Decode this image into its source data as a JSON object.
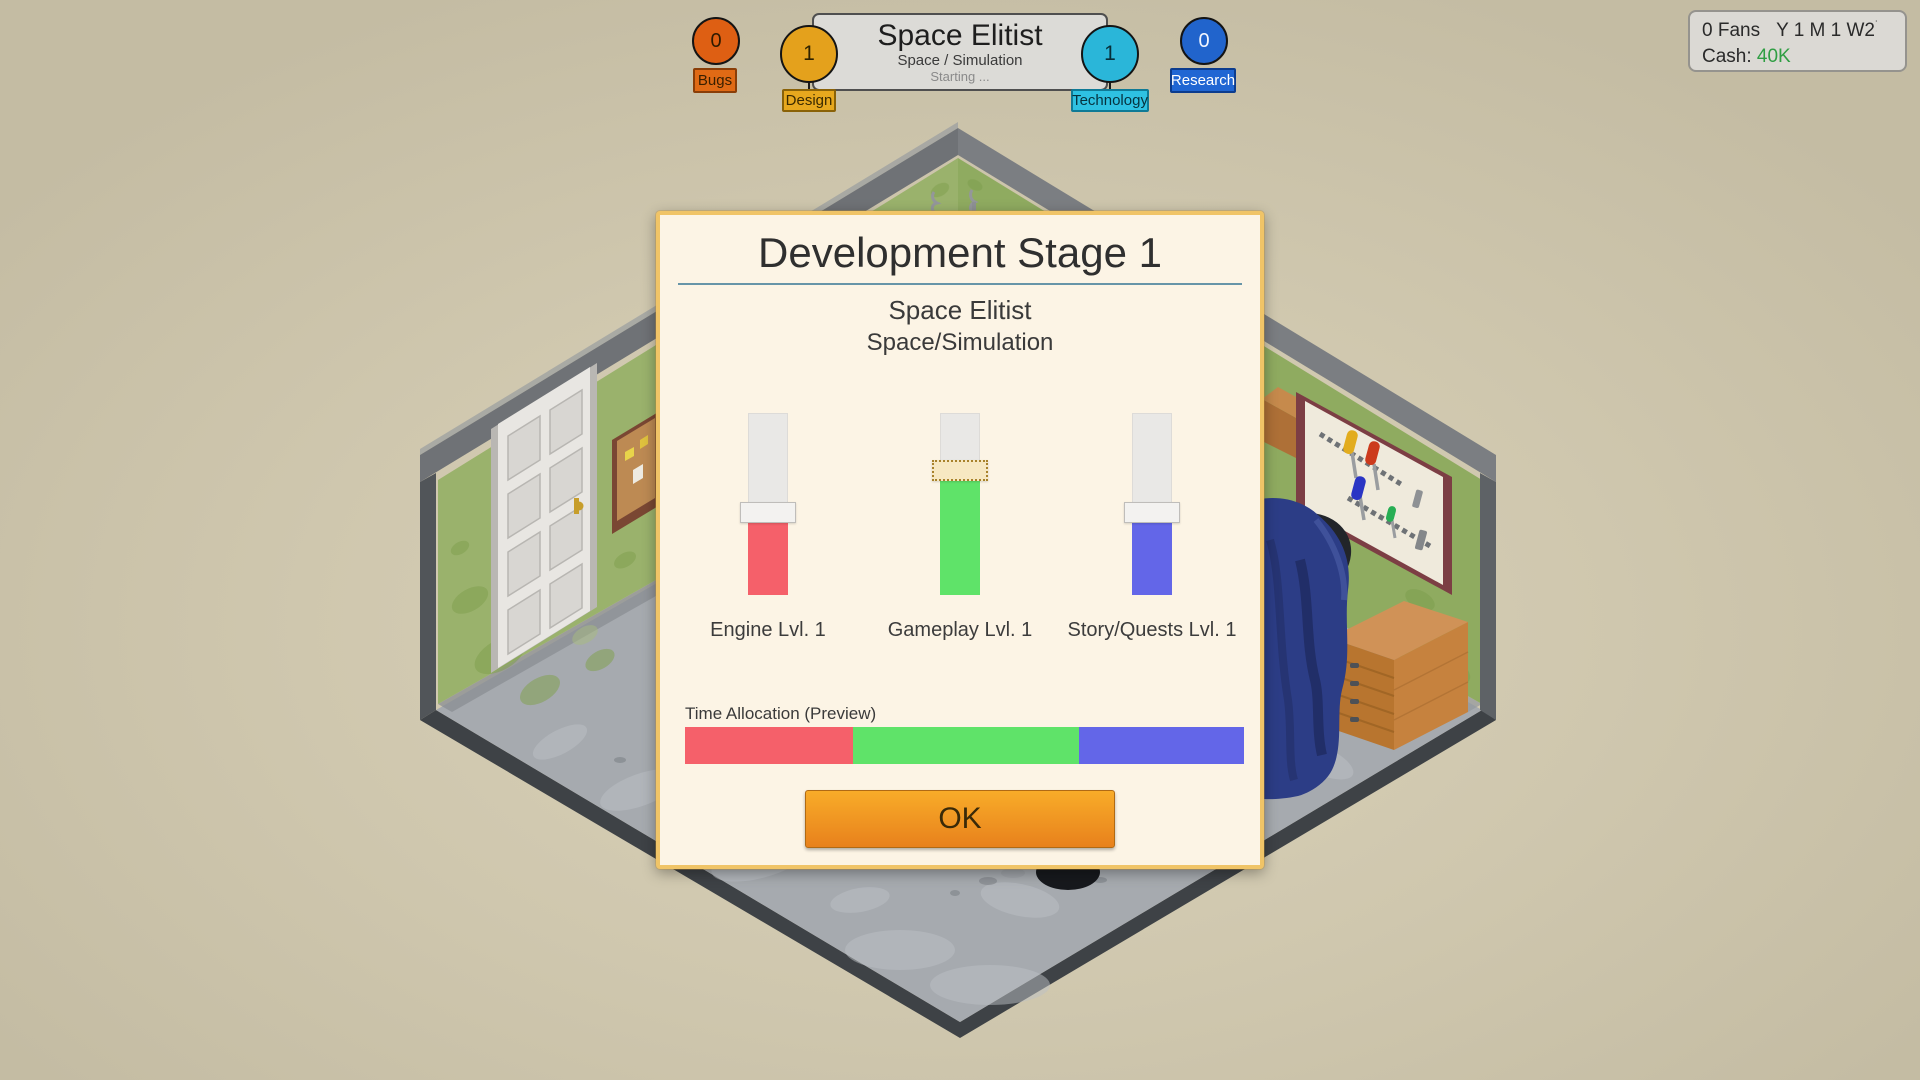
{
  "header": {
    "game_panel": {
      "title": "Space Elitist",
      "genre": "Space / Simulation",
      "status": "Starting ..."
    },
    "indicators": [
      {
        "id": "bugs",
        "label": "Bugs",
        "value": "0",
        "circle_color": "#DE5F13",
        "badge_bg": "#E06A15",
        "badge_border": "#8A3E08",
        "text_color": "#3A2000",
        "value_color": "#2E1A00"
      },
      {
        "id": "design",
        "label": "Design",
        "value": "1",
        "circle_color": "#E4A11C",
        "badge_bg": "#E7A81E",
        "badge_border": "#8A6208",
        "text_color": "#3A2A00",
        "value_color": "#2E2200"
      },
      {
        "id": "technology",
        "label": "Technology",
        "value": "1",
        "circle_color": "#2AB6D9",
        "badge_bg": "#2EC1E2",
        "badge_border": "#0F7A96",
        "text_color": "#06323E",
        "value_color": "#062E38"
      },
      {
        "id": "research",
        "label": "Research",
        "value": "0",
        "circle_color": "#2164CC",
        "badge_bg": "#2066D3",
        "badge_border": "#0C3C8E",
        "text_color": "#FFFFFF",
        "value_color": "#F2F6FF"
      }
    ]
  },
  "hud": {
    "fans": "0 Fans",
    "date": "Y 1 M 1 W2",
    "date_tick": "˙",
    "cash_label": "Cash:",
    "cash_value": "40K",
    "cash_color": "#2F9E43"
  },
  "modal": {
    "title": "Development Stage 1",
    "game_title": "Space Elitist",
    "game_genre": "Space/Simulation",
    "sliders": [
      {
        "label": "Engine Lvl. 1",
        "color": "#F5606A",
        "value_pct": 45,
        "focused": false
      },
      {
        "label": "Gameplay Lvl. 1",
        "color": "#5FE369",
        "value_pct": 71,
        "focused": true
      },
      {
        "label": "Story/Quests Lvl. 1",
        "color": "#6366E8",
        "value_pct": 45,
        "focused": false
      }
    ],
    "time_allocation": {
      "label": "Time Allocation (Preview)",
      "segments": [
        {
          "name": "engine",
          "color": "#F5606A",
          "pct": 30.0
        },
        {
          "name": "gameplay",
          "color": "#5FE369",
          "pct": 40.4
        },
        {
          "name": "story",
          "color": "#6366E8",
          "pct": 29.6
        }
      ]
    },
    "ok_label": "OK"
  }
}
